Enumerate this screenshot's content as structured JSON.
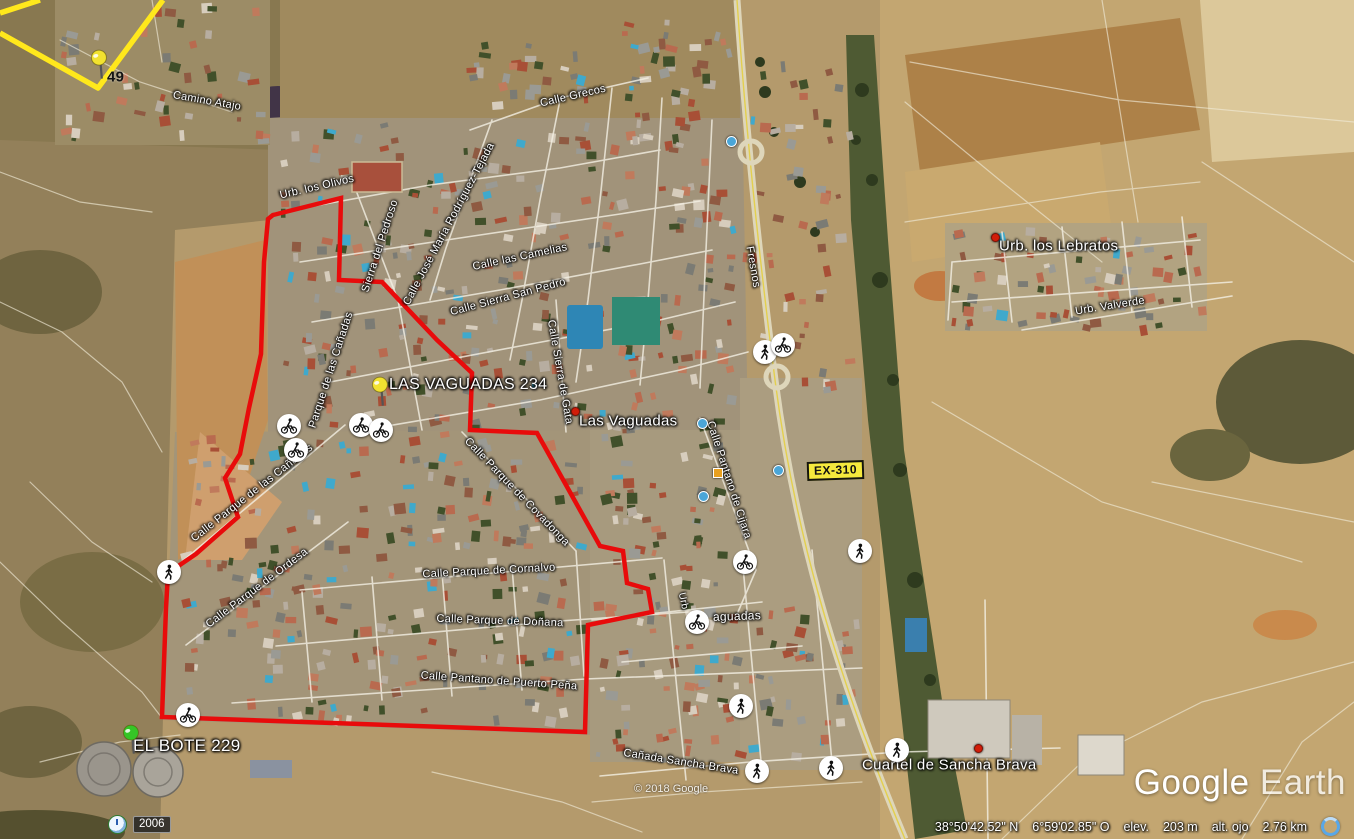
{
  "map": {
    "watermark": {
      "part1": "Google",
      "part2": "Earth"
    },
    "copyright": "© 2018 Google",
    "road_badge": "EX-310",
    "historical_year": "2006",
    "status": {
      "lat": "38°50'42.52\" N",
      "lon": "6°59'02.85\" O",
      "elev_label": "elev.",
      "elev_value": "203 m",
      "eye_label": "alt. ojo",
      "eye_value": "2.76 km"
    },
    "nav": {
      "north_label": "N",
      "zoom_in": "+",
      "zoom_out": "−"
    },
    "pins": [
      {
        "id": "pin-49",
        "label": "49",
        "color": "#f2e230",
        "x": 99,
        "y": 77,
        "lx": 107,
        "ly": 77,
        "dark": true,
        "fs": 15
      },
      {
        "id": "pin-las-vaguadas-234",
        "label": "LAS VAGUADAS 234",
        "color": "#f2e230",
        "x": 380,
        "y": 404,
        "lx": 389,
        "ly": 385,
        "dark": false,
        "fs": 16
      },
      {
        "id": "pin-el-bote-229",
        "label": "EL BOTE 229",
        "color": "#35c526",
        "x": 131,
        "y": 752,
        "lx": 133,
        "ly": 746,
        "dark": false,
        "fs": 17
      }
    ],
    "places": [
      {
        "label": "Las Vaguadas",
        "x": 579,
        "y": 421,
        "dx": 571,
        "dy": 407
      },
      {
        "label": "Urb. los Lebratos",
        "x": 999,
        "y": 246,
        "dx": 991,
        "dy": 233
      },
      {
        "label": "Cuartel de Sancha Brava",
        "x": 862,
        "y": 765,
        "dx": 974,
        "dy": 744
      }
    ],
    "street_labels": [
      {
        "text": "Camino Atajo",
        "x": 207,
        "y": 101,
        "rot": 10,
        "fs": 11
      },
      {
        "text": "Urb. los Olivos",
        "x": 317,
        "y": 187,
        "rot": -13,
        "fs": 11
      },
      {
        "text": "Calle Grecos",
        "x": 573,
        "y": 96,
        "rot": -13,
        "fs": 11
      },
      {
        "text": "Sierra del Pedroso",
        "x": 380,
        "y": 246,
        "rot": -72,
        "fs": 11
      },
      {
        "text": "Calle José María Rodríguez-Tejada",
        "x": 449,
        "y": 224,
        "rot": -62,
        "fs": 11
      },
      {
        "text": "Calle las Camelias",
        "x": 520,
        "y": 257,
        "rot": -12,
        "fs": 11
      },
      {
        "text": "Calle Sierra San Pedro",
        "x": 508,
        "y": 297,
        "rot": -15,
        "fs": 11
      },
      {
        "text": "Calle Sierra de Gata",
        "x": 560,
        "y": 372,
        "rot": 80,
        "fs": 11
      },
      {
        "text": "Fresnos",
        "x": 753,
        "y": 267,
        "rot": 80,
        "fs": 11
      },
      {
        "text": "Parque de las Cañadas",
        "x": 331,
        "y": 370,
        "rot": -72,
        "fs": 11
      },
      {
        "text": "Calle Parque de las Cañadas",
        "x": 252,
        "y": 493,
        "rot": -38,
        "fs": 11
      },
      {
        "text": "Calle Parque de Ordesa",
        "x": 257,
        "y": 588,
        "rot": -37,
        "fs": 11
      },
      {
        "text": "Calle Parque de Covadonga",
        "x": 517,
        "y": 492,
        "rot": 46,
        "fs": 11
      },
      {
        "text": "Calle Parque de Cornalvo",
        "x": 489,
        "y": 571,
        "rot": -3,
        "fs": 11
      },
      {
        "text": "Calle Parque de Doñana",
        "x": 500,
        "y": 621,
        "rot": 2,
        "fs": 11
      },
      {
        "text": "Calle Pantano de Puerto Peña",
        "x": 499,
        "y": 681,
        "rot": 4,
        "fs": 11
      },
      {
        "text": "Calle Pantano de Cijara",
        "x": 729,
        "y": 480,
        "rot": 72,
        "fs": 11
      },
      {
        "text": "Cañada Sancha Brava",
        "x": 681,
        "y": 762,
        "rot": 9,
        "fs": 11
      },
      {
        "text": "Urb. Valverde",
        "x": 1110,
        "y": 306,
        "rot": -9,
        "fs": 11
      },
      {
        "text": "Urb",
        "x": 683,
        "y": 601,
        "rot": 78,
        "fs": 10
      },
      {
        "text": "aguadas",
        "x": 737,
        "y": 616,
        "rot": -2,
        "fs": 12
      }
    ],
    "icons": {
      "walkers": [
        [
          765,
          352
        ],
        [
          860,
          551
        ],
        [
          741,
          706
        ],
        [
          757,
          771
        ],
        [
          831,
          768
        ],
        [
          169,
          572
        ],
        [
          897,
          750
        ]
      ],
      "cyclists": [
        [
          783,
          345
        ],
        [
          289,
          426
        ],
        [
          296,
          450
        ],
        [
          361,
          425
        ],
        [
          381,
          430
        ],
        [
          697,
          622
        ],
        [
          745,
          562
        ],
        [
          188,
          715
        ]
      ],
      "photo_dots": [
        [
          702,
          423
        ],
        [
          778,
          470
        ],
        [
          703,
          496
        ],
        [
          731,
          141
        ]
      ],
      "photo_squares": [
        [
          717,
          472
        ]
      ]
    }
  }
}
